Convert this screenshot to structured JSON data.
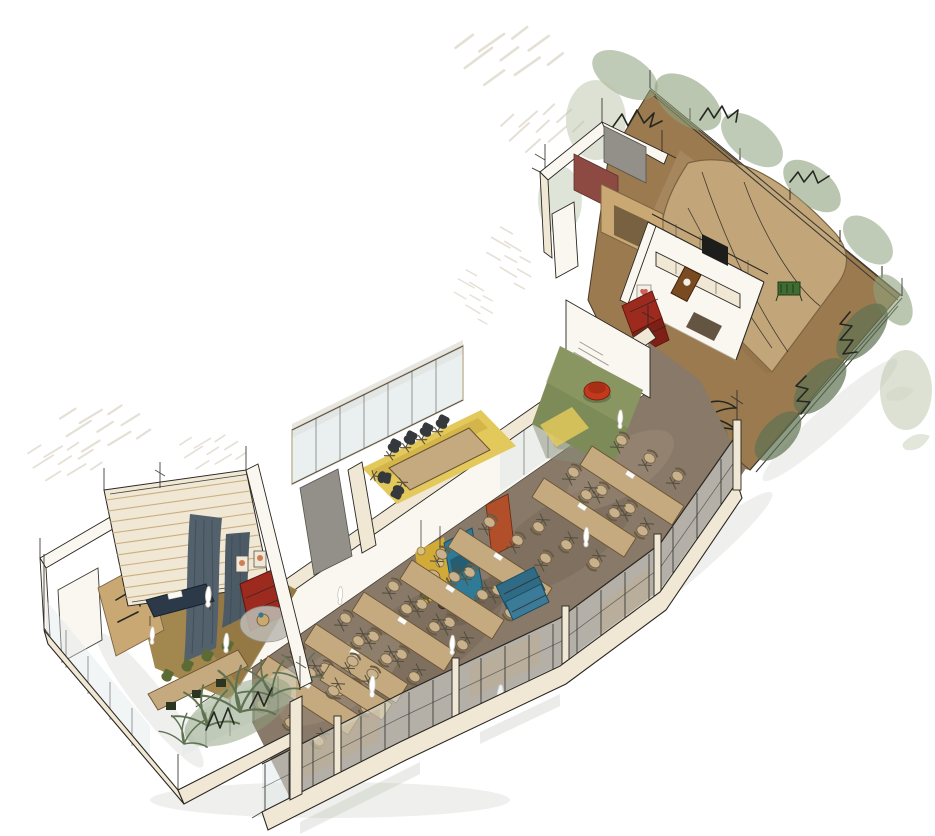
{
  "illustration": {
    "kind": "hand-drawn axonometric interior cutaway sketch",
    "visible_text": "none (illegible pencil scribbles only)"
  },
  "palette": {
    "paper": "#ffffff",
    "ink": "#2a2722",
    "wall_cream": "#f0e7d4",
    "wall_white": "#faf7f0",
    "wood_tan": "#cfae7e",
    "millwork_tan": "#c9a873",
    "millwork_recess": "#6e593b",
    "hall_floor": "#897968",
    "hall_floor_dark": "#6f6152",
    "hall_floor_light": "#a2917c",
    "left_floor": "#a2874f",
    "yellow_floor": "#e3c95c",
    "green_rug": "#7c8b58",
    "garden_ground": "#9b7a50",
    "garden_edge": "#6b5636",
    "tent": "#c2a67a",
    "tent_seam": "#8f7148",
    "foliage_light": "#b9c3a9",
    "foliage_mid": "#8da07c",
    "foliage_dark": "#5f7251",
    "ink_plant": "#232820",
    "table_tan": "#c4aa7e",
    "chair_beige": "#c9b28b",
    "chair_black": "#35393c",
    "chair_green": "#5c6b35",
    "sofa_red": "#9c2a1e",
    "sofa_red_dark": "#7e2015",
    "sofa_blue": "#3c7b97",
    "sofa_blue_dark": "#2f6b85",
    "booth_teal": "#2f7a96",
    "curtain": "#53616d",
    "navy_table": "#2b3948",
    "accent_yellow": "#e3b62b",
    "door_red": "#b14f2b",
    "maroon_panel": "#8c4a42",
    "gray_panel": "#939089",
    "glass": "#dfe7e8",
    "mullion": "#3c3c38",
    "rug_gray": "#bcbab2",
    "pouf_red": "#c2391d",
    "crate_green": "#3f6d31",
    "scribble": "#97918a",
    "hatch": "#cfc6b4",
    "frame_orange": "#c96b3a",
    "cabinet_brown": "#7a4a20",
    "mat_brown": "#574633",
    "tv_black": "#1d1d1b"
  },
  "regions": {
    "garden_terrace": {
      "floor": "#9b7a50"
    },
    "lounge_room": {
      "floor": "#faf7f0"
    },
    "green_alcove": {
      "floor": "#7c8b58"
    },
    "meeting_room": {
      "floor": "#e3c95c"
    },
    "dining_hall": {
      "floor": "#897968"
    },
    "left_wing": {
      "floor": "#a2874f"
    }
  }
}
